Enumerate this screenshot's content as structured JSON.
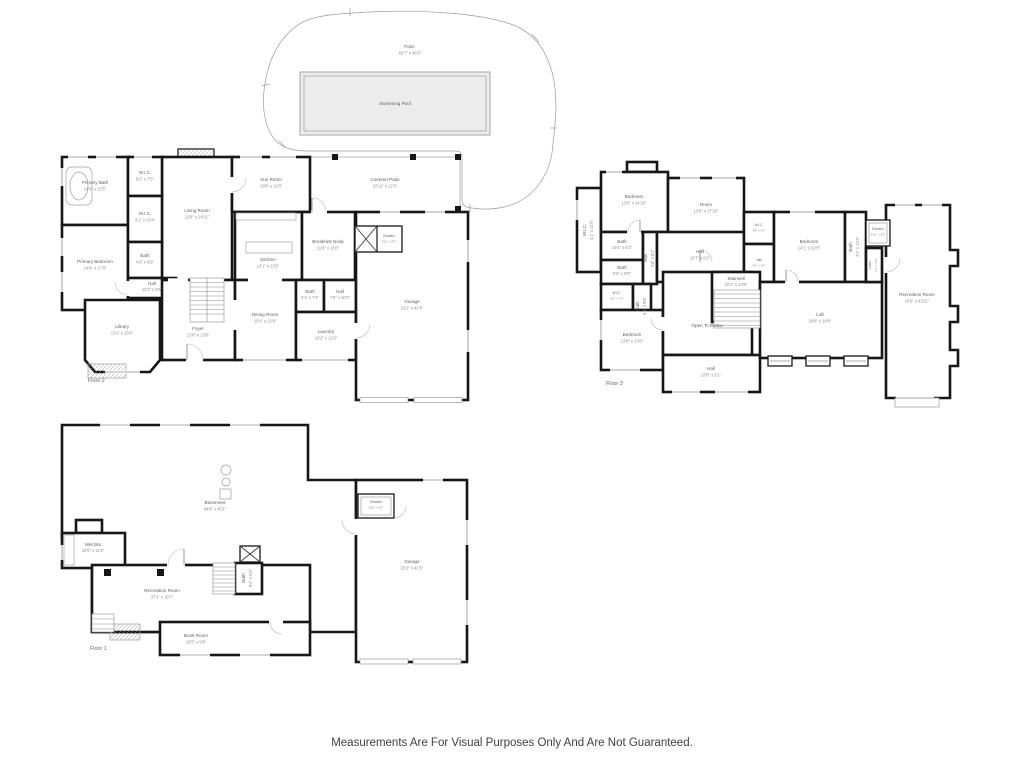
{
  "site": {
    "patio_name": "Patio",
    "patio_dims": "65'7\" x 46'5\"",
    "pool_name": "Swimming Pool"
  },
  "floor2": {
    "label": "Floor 2",
    "rooms": [
      {
        "name": "Primary Bath",
        "dims": "14'8\" x 13'5\""
      },
      {
        "name": "W.I.C.",
        "dims": "6'2\" x 7'5\""
      },
      {
        "name": "W.I.C.",
        "dims": "4'1\" x 13'4\""
      },
      {
        "name": "Bath",
        "dims": "4'2\" x 9'9\""
      },
      {
        "name": "Hall",
        "dims": "13'1\" x 3'9\""
      },
      {
        "name": "Primary Bedroom",
        "dims": "14'8\" x 17'8\""
      },
      {
        "name": "Library",
        "dims": "13'2\" x 13'6\""
      },
      {
        "name": "Living Room",
        "dims": "13'8\" x 24'11\""
      },
      {
        "name": "Foyer",
        "dims": "13'8\" x 13'8\""
      },
      {
        "name": "Sun Room",
        "dims": "19'8\" x 11'8\""
      },
      {
        "name": "Covered Patio",
        "dims": "23'11\" x 12'0\""
      },
      {
        "name": "Kitchen",
        "dims": "14'1\" x 13'0\""
      },
      {
        "name": "Breakfast Nook",
        "dims": "11'8\" x 13'0\""
      },
      {
        "name": "Elevator",
        "dims": "6'10\" x 5'4\""
      },
      {
        "name": "Bath",
        "dims": "6'1\" x 7'4\""
      },
      {
        "name": "Hall",
        "dims": "7'6\" x 10'2\""
      },
      {
        "name": "Laundry",
        "dims": "10'2\" x 13'3\""
      },
      {
        "name": "Dining Room",
        "dims": "13'4\" x 13'9\""
      },
      {
        "name": "Garage",
        "dims": "23'2\" x 41'5\""
      }
    ]
  },
  "floor3": {
    "label": "Floor 3",
    "rooms": [
      {
        "name": "Bedroom",
        "dims": "13'0\" x 14'10\""
      },
      {
        "name": "Room",
        "dims": "13'8\" x 17'10\""
      },
      {
        "name": "W.I.C.",
        "dims": "4'1\" x 12'5\""
      },
      {
        "name": "Bath",
        "dims": "10'4\" x 6'2\""
      },
      {
        "name": "Bath",
        "dims": "5'5\" x 5'9\""
      },
      {
        "name": "Hall",
        "dims": "2'8\" x 8'1\""
      },
      {
        "name": "Hall",
        "dims": "13'7\" x 8'2\""
      },
      {
        "name": "W.I.C.",
        "dims": "4'8\" x 5'4\""
      },
      {
        "name": "Hall",
        "dims": "4'0\" x 4'2\""
      },
      {
        "name": "Stairwell",
        "dims": "10'1\" x 13'8\""
      },
      {
        "name": "Bedroom",
        "dims": "14'1\" x 13'0\""
      },
      {
        "name": "Bath",
        "dims": "4'1\" x 13'2\""
      },
      {
        "name": "Elevator",
        "dims": "6'10\" x 5'4\""
      },
      {
        "name": "Linen",
        "dims": "2'6\" x 7'10\""
      },
      {
        "name": "W.I.C.",
        "dims": "5'9\" x 7'4\""
      },
      {
        "name": "Bath",
        "dims": "5'1\" x 9'9\""
      },
      {
        "name": "Bedroom",
        "dims": "13'8\" x 13'0\""
      },
      {
        "name": "Open To Below",
        "dims": ""
      },
      {
        "name": "Hall",
        "dims": "13'8\" x 5'1\""
      },
      {
        "name": "Loft",
        "dims": "24'8\" x 14'8\""
      },
      {
        "name": "Recreation Room",
        "dims": "19'6\" x 43'11\""
      }
    ]
  },
  "floor1": {
    "label": "Floor 1",
    "rooms": [
      {
        "name": "Basement",
        "dims": "84'9\" x 45'1\""
      },
      {
        "name": "Wet Bar",
        "dims": "10'0\" x 14'2\""
      },
      {
        "name": "Recreation Room",
        "dims": "37'1\" x 19'7\""
      },
      {
        "name": "Bath",
        "dims": "9'2\" x 5'8\""
      },
      {
        "name": "Bunk Room",
        "dims": "19'5\" x 9'8\""
      },
      {
        "name": "Elevator",
        "dims": "6'10\" x 5'4\""
      },
      {
        "name": "Garage",
        "dims": "23'2\" x 41'5\""
      }
    ]
  },
  "footer": {
    "disclaimer": "Measurements Are For Visual Purposes Only And Are Not Guaranteed."
  }
}
